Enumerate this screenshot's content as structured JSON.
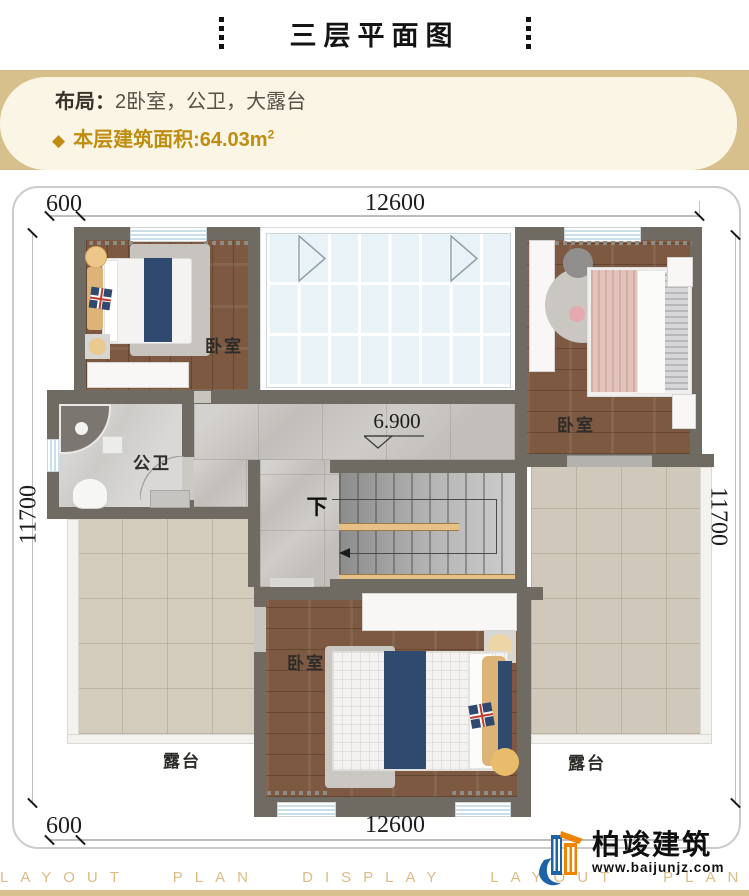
{
  "title": {
    "text": "三层平面图"
  },
  "info": {
    "layout_label": "布局：",
    "layout_value": "2卧室，公卫，大露台",
    "diamond": "◆",
    "area_label": "本层建筑面积:",
    "area_value": "64.03m",
    "area_sup": "2"
  },
  "plan": {
    "dims": {
      "top_left": "600",
      "top_center": "12600",
      "left": "11700",
      "right": "11700",
      "bottom_left": "600",
      "bottom_center": "12600"
    },
    "labels": {
      "bedroom_tl": "卧室",
      "bedroom_tr": "卧室",
      "bedroom_bottom": "卧室",
      "bathroom": "公卫",
      "terrace_left": "露台",
      "terrace_right": "露台",
      "elevation": "6.900",
      "stairs_down": "下"
    }
  },
  "logo": {
    "name": "柏竣建筑",
    "url": "www.baijunjz.com"
  },
  "watermark": {
    "text": "LAYOUT PLAN DISPLAY LAYOUT PLAN DISPLAY"
  },
  "colors": {
    "accent_gold": "#bf8e10",
    "band_tan": "#d8c08c",
    "card_cream": "#fbf5e5",
    "wall": "#6f6b63",
    "wood": "#7d5942",
    "marble": "#c2beb9",
    "terrace": "#d3cbbb",
    "glass": "#e9f3f7",
    "navy": "#2f4a6e",
    "watermark": "#dcbc86",
    "logo_blue": "#1e62a8",
    "logo_orange": "#f08300"
  }
}
